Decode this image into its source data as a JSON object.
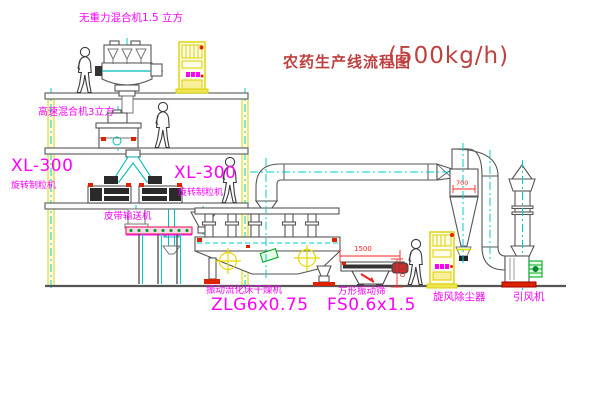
{
  "title": {
    "name": "农药生产线流程图",
    "capacity": "(500kg/h)"
  },
  "equipment": {
    "gravity_free_mixer": "无重力混合机1.5 立方",
    "high_speed_mixer": "高速混合机3立方",
    "granulator_left": {
      "model": "XL-300",
      "name": "旋转制粒机"
    },
    "granulator_right": {
      "model": "XL-300",
      "name": "旋转制粒机"
    },
    "belt_conveyor": "皮带输送机",
    "fluid_bed_dryer": {
      "name": "振动流化床干燥机",
      "model": "ZLG6x0.75"
    },
    "square_screen": {
      "name": "方形振动筛",
      "model": "FS0.6x1.5"
    },
    "cyclone": "旋风除尘器",
    "fan": "引风机"
  },
  "dimensions": {
    "screen_length": "1500",
    "screen_height": "540",
    "cyclone_width": "700"
  },
  "colors": {
    "background": "#ffffff",
    "label_magenta": "#ff00ff",
    "title_red": "#c04040",
    "dimension_red": "#ff2222",
    "structure_yellow": "#ddd000",
    "centerline_cyan": "#00cccc",
    "outline_gray": "#555555",
    "accent_red": "#dd2200",
    "accent_green": "#00aa22"
  }
}
